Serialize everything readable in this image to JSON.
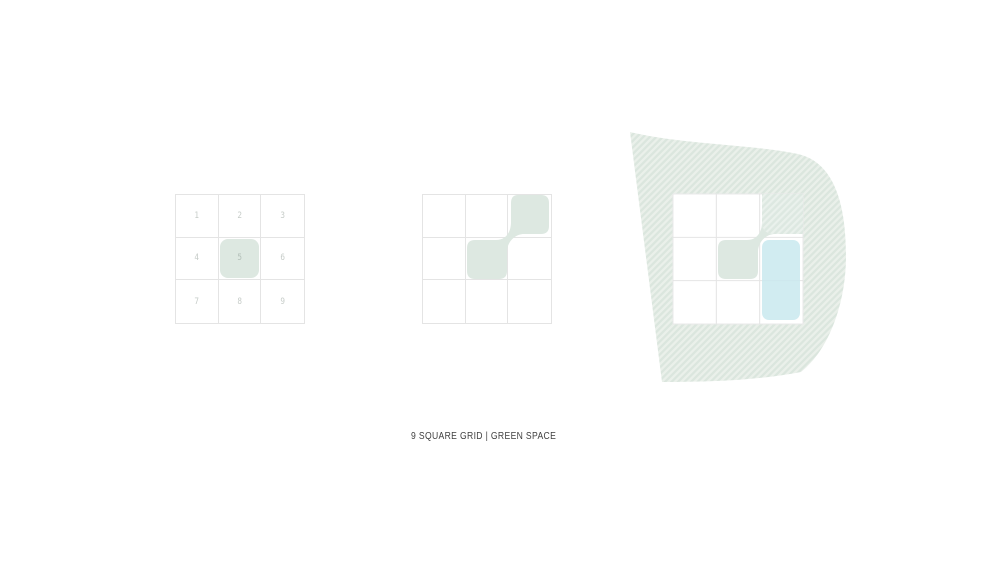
{
  "canvas": {
    "background": "#ffffff"
  },
  "caption": {
    "text": "9 SQUARE GRID | GREEN SPACE"
  },
  "colors": {
    "sage_green": "#dde8e1",
    "hatch_stripe_dark": "#dbe6de",
    "hatch_stripe_light": "#eaf0ea",
    "hatch_faint_overlay": "rgba(255,255,255,0.38)",
    "water_blue": "#c9e9ee",
    "grid_line": "#e4e4e4",
    "number_text": "#c6ccc8",
    "highlight_number_text": "#b4c0b9",
    "caption_text": "#3f3f3f"
  },
  "figures": {
    "grid1": {
      "label": "numbered 9-square grid",
      "cells": [
        "1",
        "2",
        "3",
        "4",
        "5",
        "6",
        "7",
        "8",
        "9"
      ],
      "highlighted_cell": "5"
    },
    "grid2": {
      "label": "green space connection diagram",
      "green_cells": [
        "3",
        "5"
      ]
    },
    "grid3": {
      "label": "site plan with surrounding green space",
      "green_cells": [
        "3",
        "5"
      ],
      "blue_cells": [
        "6",
        "9"
      ]
    }
  }
}
